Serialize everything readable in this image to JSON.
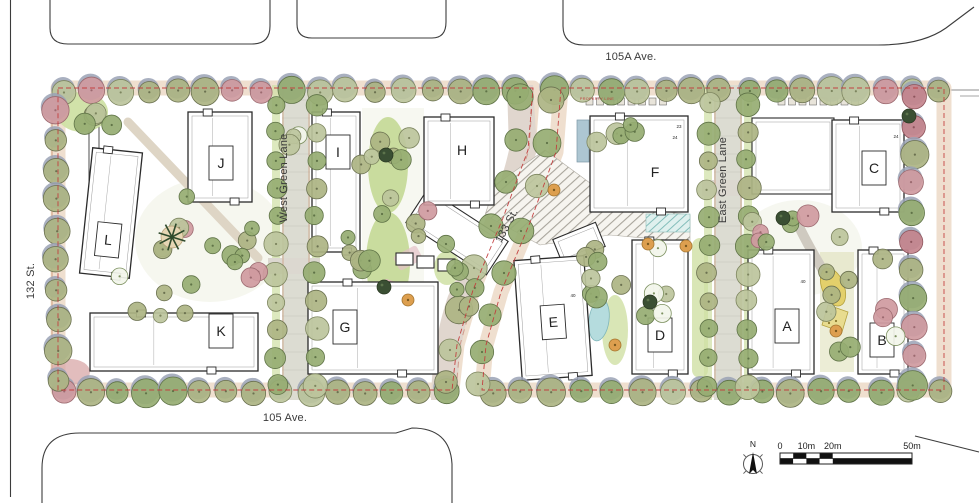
{
  "document": {
    "type": "landscape-architecture-site-plan"
  },
  "streets": [
    {
      "id": "105a-ave",
      "name": "105A Ave.",
      "x": 631,
      "y": 57,
      "rotate": 0
    },
    {
      "id": "105-ave",
      "name": "105 Ave.",
      "x": 285,
      "y": 418,
      "rotate": 0
    },
    {
      "id": "132-st",
      "name": "132 St.",
      "x": 31,
      "y": 281,
      "rotate": -90
    },
    {
      "id": "133-st",
      "name": "133 St.",
      "x": 507,
      "y": 226,
      "rotate": -62
    },
    {
      "id": "west-green-lane",
      "name": "West Green Lane",
      "x": 284,
      "y": 178,
      "rotate": -90
    },
    {
      "id": "east-green-lane",
      "name": "East Green Lane",
      "x": 723,
      "y": 180,
      "rotate": -90
    }
  ],
  "buildings": [
    {
      "letter": "A",
      "x": 748,
      "y": 250,
      "w": 66,
      "h": 124,
      "angle": 0,
      "labelX": 787,
      "labelY": 326,
      "box": true
    },
    {
      "letter": "B",
      "x": 858,
      "y": 250,
      "w": 50,
      "h": 124,
      "angle": 0,
      "labelX": 882,
      "labelY": 340,
      "box": true
    },
    {
      "letter": "C",
      "x": 832,
      "y": 120,
      "w": 72,
      "h": 92,
      "angle": 0,
      "labelX": 874,
      "labelY": 168,
      "box": true
    },
    {
      "letter": "D",
      "x": 632,
      "y": 240,
      "w": 56,
      "h": 134,
      "angle": 0,
      "labelX": 660,
      "labelY": 335,
      "box": true
    },
    {
      "letter": "E",
      "x": 518,
      "y": 258,
      "w": 70,
      "h": 120,
      "angle": -4,
      "labelX": 553,
      "labelY": 322,
      "box": true
    },
    {
      "letter": "F",
      "x": 590,
      "y": 116,
      "w": 98,
      "h": 96,
      "angle": 0,
      "labelX": 655,
      "labelY": 172,
      "box": false
    },
    {
      "letter": "G",
      "x": 308,
      "y": 282,
      "w": 130,
      "h": 92,
      "angle": 0,
      "labelX": 345,
      "labelY": 327,
      "box": true
    },
    {
      "letter": "H",
      "x": 424,
      "y": 117,
      "w": 70,
      "h": 88,
      "angle": 0,
      "labelX": 462,
      "labelY": 150,
      "box": false
    },
    {
      "letter": "I",
      "x": 312,
      "y": 112,
      "w": 48,
      "h": 140,
      "angle": 0,
      "labelX": 338,
      "labelY": 152,
      "box": true
    },
    {
      "letter": "J",
      "x": 188,
      "y": 112,
      "w": 64,
      "h": 90,
      "angle": 0,
      "labelX": 221,
      "labelY": 163,
      "box": true
    },
    {
      "letter": "K",
      "x": 90,
      "y": 313,
      "w": 168,
      "h": 58,
      "angle": 0,
      "labelX": 221,
      "labelY": 331,
      "box": true
    },
    {
      "letter": "L",
      "x": 86,
      "y": 150,
      "w": 50,
      "h": 126,
      "angle": 6,
      "labelX": 111,
      "labelY": 240,
      "box": true
    }
  ],
  "building_wings": [
    {
      "x": 752,
      "y": 118,
      "w": 82,
      "h": 76,
      "angle": 0
    },
    {
      "x": 556,
      "y": 230,
      "w": 46,
      "h": 26,
      "angle": -22
    },
    {
      "x": 409,
      "y": 212,
      "w": 96,
      "h": 40,
      "angle": 33
    },
    {
      "x": 396,
      "y": 253,
      "w": 17,
      "h": 12,
      "angle": 0
    },
    {
      "x": 417,
      "y": 256,
      "w": 17,
      "h": 12,
      "angle": 0
    },
    {
      "x": 438,
      "y": 259,
      "w": 17,
      "h": 12,
      "angle": 0
    }
  ],
  "annotations": {
    "property_line_label": "PROPERTY LINE",
    "unit_numbers": [
      {
        "text": "23",
        "x": 679,
        "y": 128
      },
      {
        "text": "24",
        "x": 675,
        "y": 139
      },
      {
        "text": "24",
        "x": 896,
        "y": 138
      },
      {
        "text": "40",
        "x": 573,
        "y": 297
      },
      {
        "text": "40",
        "x": 803,
        "y": 283
      }
    ]
  },
  "map_legend": {
    "north_label": "N",
    "scale_bar": {
      "labels": [
        "0",
        "10m",
        "20m",
        "50m"
      ],
      "label_meters": [
        0,
        10,
        20,
        50
      ],
      "length_m": 50
    }
  },
  "colors": {
    "property_line": "#c23b3b",
    "building_fill": "#ffffff",
    "building_stroke": "#2b2b2b",
    "tree_olive": "#adb483",
    "tree_green": "#96ad72",
    "tree_sage": "#bcc49c",
    "tree_pink": "#cf9aa0",
    "tree_red": "#c4848d",
    "tree_dark": "#3a4f33",
    "tree_orange": "#dd9f4f",
    "canopy_shadow": "#9aa2b5",
    "lawn": "#cfe0a4",
    "sidewalk": "#ecd9c7",
    "paving": "#e0d6ce",
    "water": "#b5dcde",
    "label_text": "#3a3a3a"
  }
}
